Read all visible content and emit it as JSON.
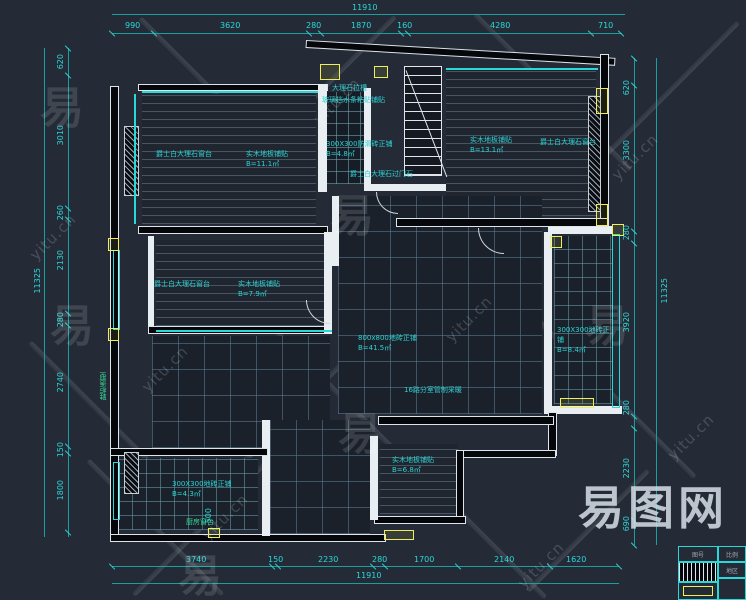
{
  "watermark": {
    "text": "yitu.cn",
    "glyph": "易",
    "logo": "易图网"
  },
  "colors": {
    "background": "#242b37",
    "dimension_cyan": "#2bd8d8",
    "highlight_yellow": "#f0ee5a",
    "wall_white": "#e9eef3",
    "label_green": "#36d89b"
  },
  "dims": {
    "top": {
      "overall": "11910",
      "segments": [
        "990",
        "3620",
        "280",
        "1870",
        "160",
        "4280",
        "710"
      ]
    },
    "bottom": {
      "overall": "11910",
      "segments": [
        "3740",
        "150",
        "2230",
        "280",
        "1700",
        "2140",
        "1620"
      ]
    },
    "left": {
      "overall": "11325",
      "segments": [
        "620",
        "3010",
        "260",
        "2130",
        "280",
        "2740",
        "150",
        "1800"
      ]
    },
    "right": {
      "overall": "11325",
      "segments": [
        "620",
        "3300",
        "280",
        "3920",
        "280",
        "2230",
        "690"
      ]
    },
    "misc": {
      "kitchen_depth": "500"
    }
  },
  "rooms": {
    "bedroom_top_left": {
      "sill": "爵士白大理石窗台",
      "floor": "实木地板铺贴",
      "area": "B=11.1㎡"
    },
    "bathroom_top": {
      "line1": "大理石拉槽",
      "line2": "玻璃挡水条粘贴铺贴",
      "floor": "300X300防滑砖正铺",
      "area": "B=4.8㎡",
      "threshold": "爵士白大理石过门石"
    },
    "bedroom_top_right": {
      "floor": "实木地板铺贴",
      "area": "B=13.1㎡",
      "sill": "爵士白大理石窗台"
    },
    "study": {
      "sill": "爵士白大理石窗台",
      "floor": "实木地板铺贴",
      "area": "B=7.9㎡"
    },
    "living": {
      "floor": "800x800地砖正铺",
      "area": "B=41.5㎡",
      "note": "16路分室管制采暖"
    },
    "balcony": {
      "floor": "300X300地砖正铺",
      "area": "B=8.4㎡"
    },
    "kitchen": {
      "floor": "300X300地砖正铺",
      "area": "B=4.3㎡",
      "sill": "厨房窗台"
    },
    "bedroom_bottom": {
      "floor": "实木地板铺贴",
      "area": "B=6.8㎡"
    },
    "entry": {
      "cabinet": "鞋柜造型"
    }
  },
  "titleblock": {
    "cell1": "图号",
    "cell2": "比例",
    "cell3": "地区"
  }
}
